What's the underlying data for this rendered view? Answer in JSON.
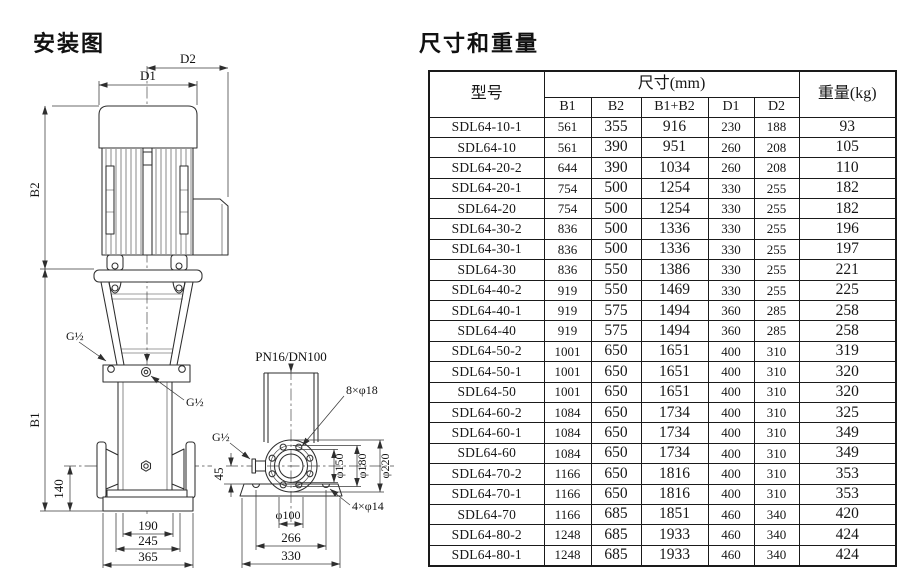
{
  "page": {
    "background": "#ffffff",
    "line_ink": "#2e2e2e",
    "text_ink": "#111111"
  },
  "installation": {
    "title": "安装图",
    "labels": {
      "d1": "D1",
      "d2": "D2",
      "b1": "B1",
      "b2": "B2",
      "g_half": "G½",
      "dim140": "140",
      "dim190": "190",
      "dim245": "245",
      "dim365": "365",
      "dim45": "45",
      "pn": "PN16/DN100",
      "flange_holes": "8×φ18",
      "base_holes": "4×φ14",
      "phi150": "φ150",
      "phi180": "φ180",
      "phi220": "φ220",
      "phi100": "φ100",
      "dim266": "266",
      "dim330": "330"
    }
  },
  "dimensions_section": {
    "title": "尺寸和重量",
    "table": {
      "header": {
        "model": "型号",
        "size_group": "尺寸(mm)",
        "weight": "重量(kg)",
        "size_cols": [
          "B1",
          "B2",
          "B1+B2",
          "D1",
          "D2"
        ]
      },
      "rows": [
        [
          "SDL64-10-1",
          "561",
          "355",
          "916",
          "230",
          "188",
          "93"
        ],
        [
          "SDL64-10",
          "561",
          "390",
          "951",
          "260",
          "208",
          "105"
        ],
        [
          "SDL64-20-2",
          "644",
          "390",
          "1034",
          "260",
          "208",
          "110"
        ],
        [
          "SDL64-20-1",
          "754",
          "500",
          "1254",
          "330",
          "255",
          "182"
        ],
        [
          "SDL64-20",
          "754",
          "500",
          "1254",
          "330",
          "255",
          "182"
        ],
        [
          "SDL64-30-2",
          "836",
          "500",
          "1336",
          "330",
          "255",
          "196"
        ],
        [
          "SDL64-30-1",
          "836",
          "500",
          "1336",
          "330",
          "255",
          "197"
        ],
        [
          "SDL64-30",
          "836",
          "550",
          "1386",
          "330",
          "255",
          "221"
        ],
        [
          "SDL64-40-2",
          "919",
          "550",
          "1469",
          "330",
          "255",
          "225"
        ],
        [
          "SDL64-40-1",
          "919",
          "575",
          "1494",
          "360",
          "285",
          "258"
        ],
        [
          "SDL64-40",
          "919",
          "575",
          "1494",
          "360",
          "285",
          "258"
        ],
        [
          "SDL64-50-2",
          "1001",
          "650",
          "1651",
          "400",
          "310",
          "319"
        ],
        [
          "SDL64-50-1",
          "1001",
          "650",
          "1651",
          "400",
          "310",
          "320"
        ],
        [
          "SDL64-50",
          "1001",
          "650",
          "1651",
          "400",
          "310",
          "320"
        ],
        [
          "SDL64-60-2",
          "1084",
          "650",
          "1734",
          "400",
          "310",
          "325"
        ],
        [
          "SDL64-60-1",
          "1084",
          "650",
          "1734",
          "400",
          "310",
          "349"
        ],
        [
          "SDL64-60",
          "1084",
          "650",
          "1734",
          "400",
          "310",
          "349"
        ],
        [
          "SDL64-70-2",
          "1166",
          "650",
          "1816",
          "400",
          "310",
          "353"
        ],
        [
          "SDL64-70-1",
          "1166",
          "650",
          "1816",
          "400",
          "310",
          "353"
        ],
        [
          "SDL64-70",
          "1166",
          "685",
          "1851",
          "460",
          "340",
          "420"
        ],
        [
          "SDL64-80-2",
          "1248",
          "685",
          "1933",
          "460",
          "340",
          "424"
        ],
        [
          "SDL64-80-1",
          "1248",
          "685",
          "1933",
          "460",
          "340",
          "424"
        ]
      ]
    }
  }
}
